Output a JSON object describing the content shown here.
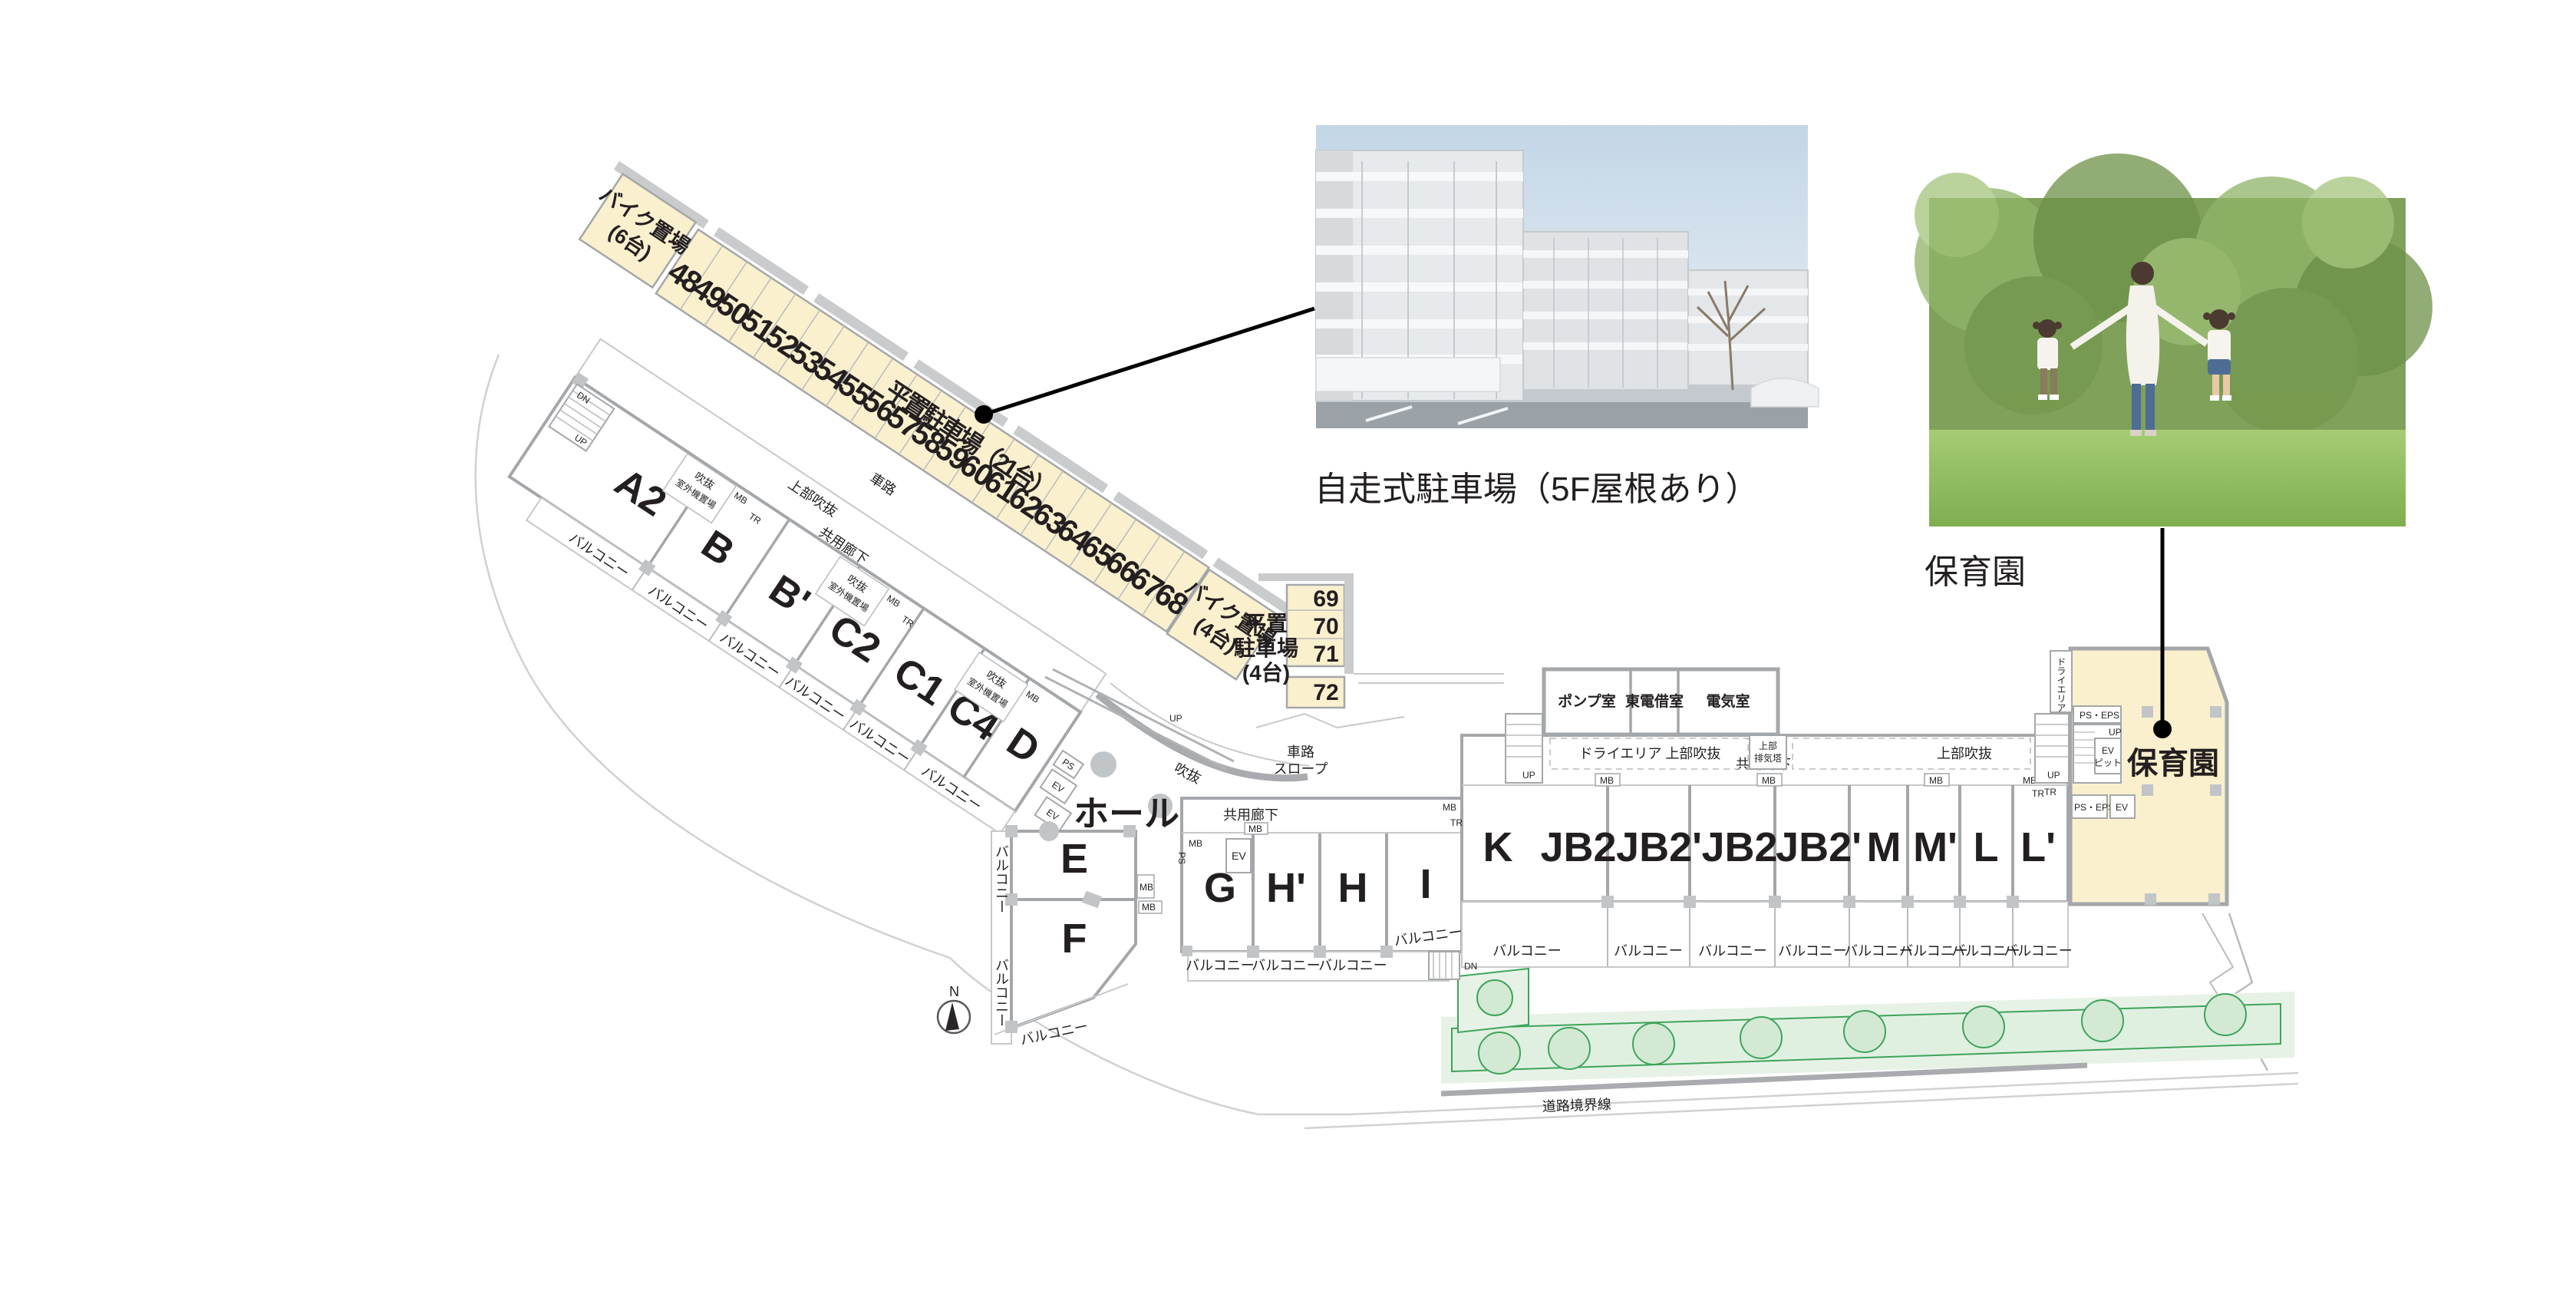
{
  "colors": {
    "parking_yellow": "#FAF0CE",
    "wall_gray": "#A4A7AA",
    "column_gray": "#C2C5C7",
    "road_gray": "#C6C8CA",
    "green_stroke": "#3FA45B",
    "green_bed": "#E7F2E7",
    "tree_fill": "#D3E9D4",
    "text": "#231F20",
    "annotation": "#000000"
  },
  "parking_strip": {
    "label": "平置駐車場（21台）",
    "stalls": [
      "48",
      "49",
      "50",
      "51",
      "52",
      "53",
      "54",
      "55",
      "56",
      "57",
      "58",
      "59",
      "60",
      "61",
      "62",
      "63",
      "64",
      "65",
      "66",
      "67",
      "68"
    ],
    "bike6_line1": "バイク置場",
    "bike6_line2": "(6台)",
    "bike4_line1": "バイク置場",
    "bike4_line2": "(4台)"
  },
  "flat_parking": {
    "label_line1": "平置",
    "label_line2": "駐車場",
    "label_line3": "(4台)",
    "stalls": [
      "69",
      "70",
      "71",
      "72"
    ]
  },
  "units": [
    "A2",
    "B",
    "B'",
    "C2",
    "C1",
    "C4",
    "D",
    "E",
    "F",
    "G",
    "H'",
    "H",
    "I",
    "K",
    "JB2",
    "JB2'",
    "JB2",
    "JB2'",
    "M",
    "M'",
    "L",
    "L'"
  ],
  "rooms": {
    "pump": "ポンプ室",
    "tepco": "東電借室",
    "electric": "電気室",
    "nursery": "保育園",
    "hall": "ホール"
  },
  "labels": {
    "balcony": "バルコニー",
    "corridor": "共用廊下",
    "void_upper": "上部吹抜",
    "void": "吹抜",
    "outdoor_unit": "室外機置場",
    "dry_area": "ドライエリア",
    "dry_area_void": "ドライエリア 上部吹抜",
    "exhaust_line1": "上部",
    "exhaust_line2": "排気塔",
    "ev_pit_line1": "EV",
    "ev_pit_line2": "ピット",
    "ps_eps": "PS・EPS",
    "mb": "MB",
    "tr": "TR",
    "ps": "PS",
    "ev": "EV",
    "up": "UP",
    "dn": "DN",
    "road": "車路",
    "slope": "スロープ",
    "road_boundary": "道路境界線",
    "north": "N"
  },
  "photos": {
    "building": {
      "caption": "自走式駐車場（5F屋根あり）"
    },
    "family": {
      "caption": "保育園"
    }
  }
}
